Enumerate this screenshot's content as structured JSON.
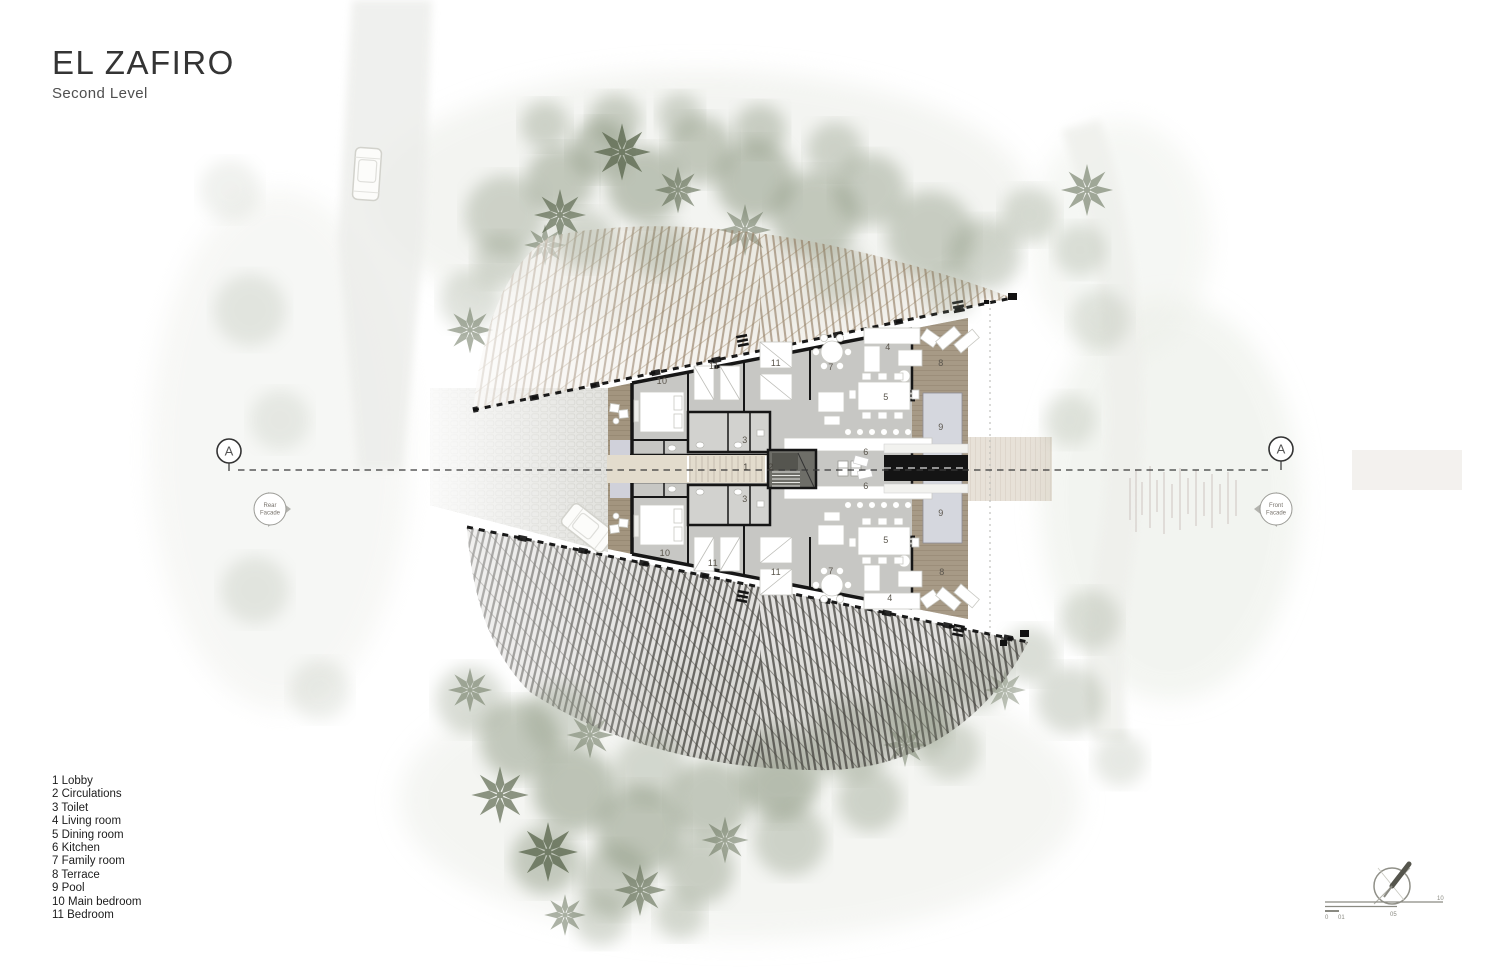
{
  "title": {
    "name": "EL ZAFIRO",
    "level": "Second Level"
  },
  "legend": {
    "items": [
      "1 Lobby",
      "2 Circulations",
      "3 Toilet",
      "4 Living room",
      "5 Dining room",
      "6 Kitchen",
      "7 Family room",
      "8 Terrace",
      "9 Pool",
      "10 Main bedroom",
      "11 Bedroom"
    ]
  },
  "section_markers": {
    "left_label": "A",
    "right_label": "A",
    "rear": {
      "line1": "Rear",
      "line2": "Facade"
    },
    "front": {
      "line1": "Front",
      "line2": "Facade"
    }
  },
  "scale_bar": {
    "labels": [
      "0",
      "01",
      "05",
      "10"
    ]
  },
  "plan": {
    "room_labels": [
      {
        "text": "10"
      },
      {
        "text": "11"
      },
      {
        "text": "11"
      },
      {
        "text": "7"
      },
      {
        "text": "4"
      },
      {
        "text": "5"
      },
      {
        "text": "8"
      },
      {
        "text": "9"
      },
      {
        "text": "6"
      },
      {
        "text": "3"
      },
      {
        "text": "1"
      },
      {
        "text": "2"
      },
      {
        "text": "3"
      },
      {
        "text": "6"
      },
      {
        "text": "9"
      },
      {
        "text": "5"
      },
      {
        "text": "10"
      },
      {
        "text": "11"
      },
      {
        "text": "11"
      },
      {
        "text": "7"
      },
      {
        "text": "8"
      },
      {
        "text": "4"
      }
    ]
  },
  "colors": {
    "wall": "#161616",
    "floor": "#c7c7c4",
    "wood_deck": "#a3957f",
    "roof_tan": "#8e775b",
    "roof_dark": "#474540",
    "pool": "#d5d7de",
    "tree": "#87937b",
    "corridor": "#e3dccd"
  }
}
